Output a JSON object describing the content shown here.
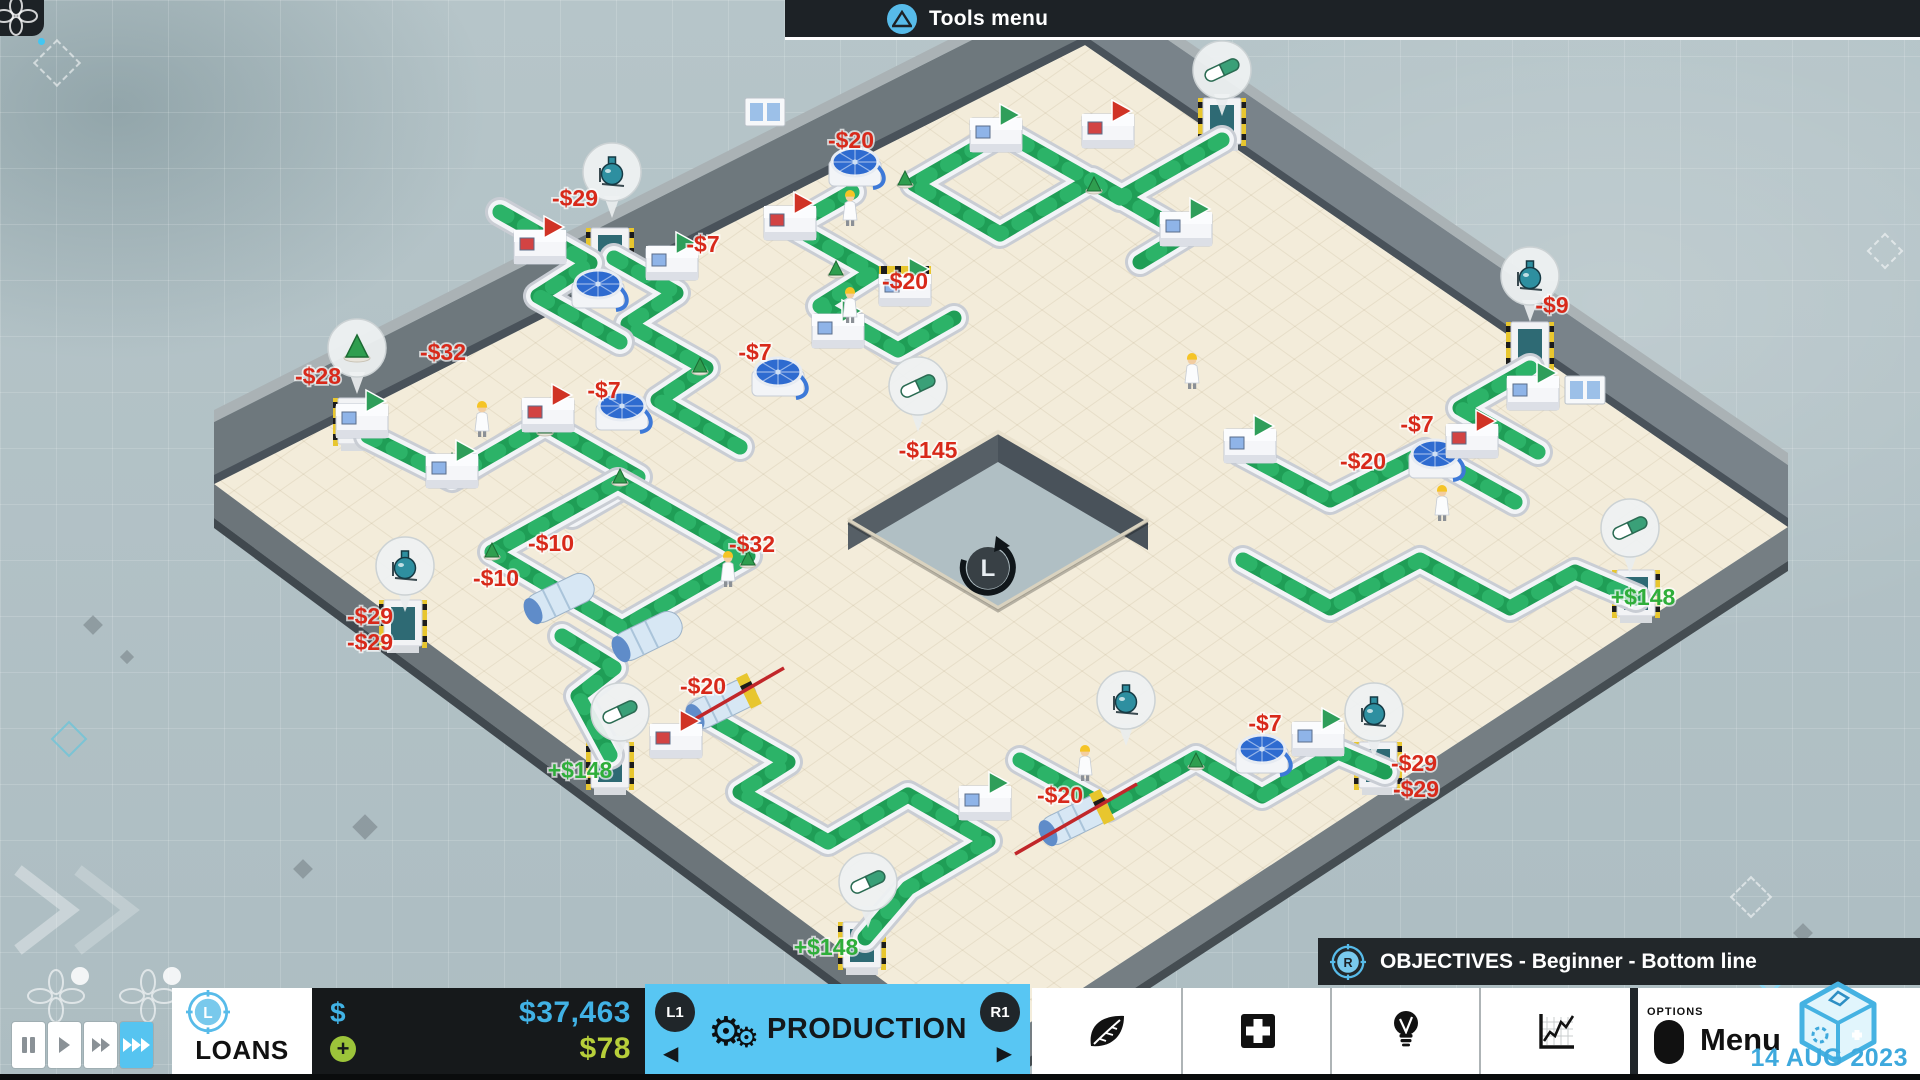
{
  "top_bar": {
    "button_icon": "triangle-button",
    "tools_menu_label": "Tools menu"
  },
  "objectives_bar": {
    "stick_button": "R",
    "label": "OBJECTIVES - Beginner - Bottom line"
  },
  "bottom_bar": {
    "playback": {
      "buttons": [
        "pause",
        "play",
        "fast-forward",
        "fastest"
      ],
      "active": "fastest"
    },
    "loans": {
      "stick_button": "L",
      "label": "LOANS"
    },
    "money": {
      "currency_symbol": "$",
      "balance": "$37,463",
      "income_plus": "+",
      "income": "$78"
    },
    "production_tab": {
      "left_shoulder": "L1",
      "right_shoulder": "R1",
      "label": "PRODUCTION",
      "left_arrow": "◀",
      "right_arrow": "▶",
      "gear_icons": [
        "⚙",
        "⚙"
      ]
    },
    "panel_buttons": [
      {
        "icon": "leaf-icon"
      },
      {
        "icon": "medical-cross-icon"
      },
      {
        "icon": "lightbulb-icon"
      },
      {
        "icon": "line-chart-icon"
      }
    ],
    "menu": {
      "button_hint": "OPTIONS",
      "label": "Menu"
    },
    "date": "14 AUG 2023",
    "logo": "cube-logo"
  },
  "colors": {
    "accent_blue": "#57bbe9",
    "production_blue": "#58c6f3",
    "money_blue": "#41b2e5",
    "income_green": "#b7cf3a",
    "cost_red": "#d8291a",
    "revenue_green": "#2fae3a",
    "floor": "#f3ecda",
    "wall_dark": "#49525a",
    "belt_green": "#1f9e56",
    "bar_dark": "#1d2226"
  },
  "factory": {
    "floor_corners": [
      [
        214,
        484
      ],
      [
        1085,
        45
      ],
      [
        1788,
        527
      ],
      [
        982,
        1054
      ]
    ],
    "hole_corners": [
      [
        998,
        432
      ],
      [
        1148,
        520
      ],
      [
        998,
        608
      ],
      [
        848,
        520
      ]
    ],
    "compass": {
      "label": "L",
      "x": 988,
      "y": 568
    },
    "price_labels": [
      {
        "t": "-$20",
        "x": 851,
        "y": 148,
        "k": "cost"
      },
      {
        "t": "-$29",
        "x": 575,
        "y": 206,
        "k": "cost"
      },
      {
        "t": "-$7",
        "x": 703,
        "y": 252,
        "k": "cost"
      },
      {
        "t": "-$20",
        "x": 905,
        "y": 289,
        "k": "cost"
      },
      {
        "t": "-$32",
        "x": 443,
        "y": 360,
        "k": "cost"
      },
      {
        "t": "-$28",
        "x": 318,
        "y": 384,
        "k": "cost"
      },
      {
        "t": "-$7",
        "x": 604,
        "y": 398,
        "k": "cost"
      },
      {
        "t": "-$7",
        "x": 755,
        "y": 360,
        "k": "cost"
      },
      {
        "t": "-$10",
        "x": 551,
        "y": 551,
        "k": "cost"
      },
      {
        "t": "-$10",
        "x": 496,
        "y": 586,
        "k": "cost"
      },
      {
        "t": "-$32",
        "x": 752,
        "y": 552,
        "k": "cost"
      },
      {
        "t": "-$29",
        "x": 370,
        "y": 624,
        "k": "cost"
      },
      {
        "t": "-$29",
        "x": 370,
        "y": 650,
        "k": "cost"
      },
      {
        "t": "-$145",
        "x": 928,
        "y": 458,
        "k": "cost"
      },
      {
        "t": "-$20",
        "x": 703,
        "y": 694,
        "k": "cost"
      },
      {
        "t": "-$20",
        "x": 1060,
        "y": 803,
        "k": "cost"
      },
      {
        "t": "-$7",
        "x": 1265,
        "y": 731,
        "k": "cost"
      },
      {
        "t": "-$29",
        "x": 1414,
        "y": 771,
        "k": "cost"
      },
      {
        "t": "-$29",
        "x": 1416,
        "y": 797,
        "k": "cost"
      },
      {
        "t": "-$9",
        "x": 1552,
        "y": 313,
        "k": "cost"
      },
      {
        "t": "-$7",
        "x": 1417,
        "y": 432,
        "k": "cost"
      },
      {
        "t": "-$20",
        "x": 1363,
        "y": 469,
        "k": "cost"
      },
      {
        "t": "+$148",
        "x": 580,
        "y": 778,
        "k": "rev"
      },
      {
        "t": "+$148",
        "x": 826,
        "y": 955,
        "k": "rev"
      },
      {
        "t": "+$148",
        "x": 1643,
        "y": 605,
        "k": "rev"
      }
    ],
    "bubbles": [
      {
        "i": "flask",
        "x": 612,
        "y": 172
      },
      {
        "i": "cone",
        "x": 357,
        "y": 348
      },
      {
        "i": "flask",
        "x": 405,
        "y": 566
      },
      {
        "i": "pill",
        "x": 918,
        "y": 386
      },
      {
        "i": "pill",
        "x": 620,
        "y": 712
      },
      {
        "i": "pill",
        "x": 868,
        "y": 882
      },
      {
        "i": "pill",
        "x": 1222,
        "y": 70
      },
      {
        "i": "pill",
        "x": 1630,
        "y": 528
      },
      {
        "i": "flask",
        "x": 1374,
        "y": 712
      },
      {
        "i": "flask",
        "x": 1530,
        "y": 276
      },
      {
        "i": "flask",
        "x": 1126,
        "y": 700
      }
    ],
    "doors": [
      {
        "x": 610,
        "y": 258
      },
      {
        "x": 357,
        "y": 428
      },
      {
        "x": 403,
        "y": 630
      },
      {
        "x": 610,
        "y": 772
      },
      {
        "x": 862,
        "y": 952
      },
      {
        "x": 1222,
        "y": 128
      },
      {
        "x": 1530,
        "y": 352
      },
      {
        "x": 1378,
        "y": 772
      },
      {
        "x": 1636,
        "y": 600
      }
    ],
    "windows": [
      {
        "x": 765,
        "y": 112
      },
      {
        "x": 1585,
        "y": 390
      }
    ],
    "conveyors": [
      [
        [
          614,
          258
        ],
        [
          676,
          293
        ],
        [
          628,
          324
        ],
        [
          706,
          368
        ],
        [
          658,
          400
        ],
        [
          740,
          447
        ]
      ],
      [
        [
          500,
          212
        ],
        [
          590,
          263
        ],
        [
          538,
          296
        ],
        [
          620,
          342
        ]
      ],
      [
        [
          852,
          192
        ],
        [
          792,
          226
        ],
        [
          874,
          272
        ],
        [
          820,
          306
        ],
        [
          898,
          350
        ],
        [
          954,
          318
        ]
      ],
      [
        [
          1222,
          140
        ],
        [
          1120,
          198
        ],
        [
          1004,
          132
        ],
        [
          914,
          184
        ],
        [
          1000,
          234
        ],
        [
          1092,
          180
        ],
        [
          1186,
          234
        ],
        [
          1140,
          262
        ]
      ],
      [
        [
          368,
          436
        ],
        [
          452,
          478
        ],
        [
          545,
          424
        ],
        [
          638,
          477
        ],
        [
          572,
          515
        ]
      ],
      [
        [
          492,
          552
        ],
        [
          622,
          628
        ],
        [
          748,
          556
        ],
        [
          618,
          482
        ],
        [
          492,
          552
        ]
      ],
      [
        [
          562,
          636
        ],
        [
          614,
          668
        ],
        [
          578,
          696
        ],
        [
          610,
          755
        ]
      ],
      [
        [
          700,
          712
        ],
        [
          788,
          762
        ],
        [
          740,
          792
        ],
        [
          828,
          842
        ],
        [
          908,
          795
        ],
        [
          988,
          841
        ],
        [
          908,
          888
        ],
        [
          865,
          938
        ]
      ],
      [
        [
          1020,
          760
        ],
        [
          1108,
          808
        ],
        [
          1196,
          758
        ],
        [
          1262,
          796
        ],
        [
          1338,
          752
        ],
        [
          1385,
          772
        ]
      ],
      [
        [
          1243,
          560
        ],
        [
          1330,
          608
        ],
        [
          1420,
          560
        ],
        [
          1510,
          608
        ],
        [
          1575,
          572
        ],
        [
          1636,
          598
        ]
      ],
      [
        [
          1530,
          368
        ],
        [
          1460,
          408
        ],
        [
          1538,
          452
        ]
      ],
      [
        [
          1240,
          452
        ],
        [
          1330,
          500
        ],
        [
          1425,
          452
        ],
        [
          1515,
          502
        ]
      ]
    ],
    "machines": [
      {
        "x": 855,
        "y": 170,
        "t": "bluedisc"
      },
      {
        "x": 672,
        "y": 262,
        "t": "boxg"
      },
      {
        "x": 598,
        "y": 292,
        "t": "bluedisc"
      },
      {
        "x": 540,
        "y": 246,
        "t": "boxr"
      },
      {
        "x": 905,
        "y": 288,
        "t": "hazard"
      },
      {
        "x": 838,
        "y": 330,
        "t": "boxg"
      },
      {
        "x": 790,
        "y": 222,
        "t": "boxr"
      },
      {
        "x": 1108,
        "y": 130,
        "t": "boxr"
      },
      {
        "x": 996,
        "y": 134,
        "t": "boxg"
      },
      {
        "x": 1186,
        "y": 228,
        "t": "boxg"
      },
      {
        "x": 622,
        "y": 414,
        "t": "bluedisc"
      },
      {
        "x": 778,
        "y": 380,
        "t": "bluedisc"
      },
      {
        "x": 548,
        "y": 414,
        "t": "boxr"
      },
      {
        "x": 452,
        "y": 470,
        "t": "boxg"
      },
      {
        "x": 362,
        "y": 420,
        "t": "boxg"
      },
      {
        "x": 560,
        "y": 598,
        "t": "cylinder"
      },
      {
        "x": 648,
        "y": 636,
        "t": "cylinder"
      },
      {
        "x": 722,
        "y": 704,
        "t": "crossed"
      },
      {
        "x": 676,
        "y": 740,
        "t": "boxr"
      },
      {
        "x": 1075,
        "y": 820,
        "t": "crossed"
      },
      {
        "x": 985,
        "y": 802,
        "t": "boxg"
      },
      {
        "x": 1262,
        "y": 757,
        "t": "bluedisc"
      },
      {
        "x": 1318,
        "y": 738,
        "t": "boxg"
      },
      {
        "x": 1435,
        "y": 462,
        "t": "bluedisc"
      },
      {
        "x": 1472,
        "y": 440,
        "t": "boxr"
      },
      {
        "x": 1250,
        "y": 445,
        "t": "boxg"
      },
      {
        "x": 1533,
        "y": 392,
        "t": "boxg"
      }
    ],
    "workers": [
      [
        850,
        205
      ],
      [
        482,
        416
      ],
      [
        850,
        302
      ],
      [
        728,
        566
      ],
      [
        1085,
        760
      ],
      [
        1442,
        500
      ],
      [
        1192,
        368
      ]
    ],
    "belt_items": [
      [
        452,
        462
      ],
      [
        545,
        428
      ],
      [
        620,
        478
      ],
      [
        905,
        180
      ],
      [
        836,
        270
      ],
      [
        700,
        367
      ],
      [
        1094,
        186
      ],
      [
        492,
        552
      ],
      [
        748,
        560
      ],
      [
        1196,
        762
      ]
    ]
  }
}
